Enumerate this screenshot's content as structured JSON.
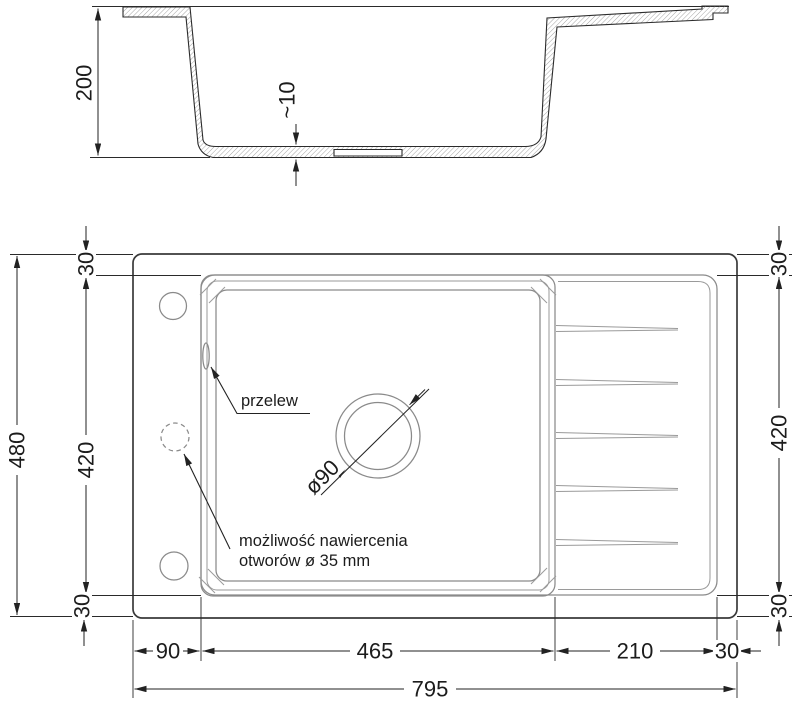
{
  "cross_section": {
    "depth": "200",
    "bottom_thickness": "~10"
  },
  "plan": {
    "left": {
      "total": "480",
      "inner": "420",
      "top": "30",
      "bottom": "30"
    },
    "right": {
      "top": "30",
      "inner": "420",
      "bottom": "30"
    },
    "bottom": {
      "left": "90",
      "bowl": "465",
      "drainer": "210",
      "right": "30",
      "total": "795"
    },
    "drain_diameter": "ø90",
    "overflow_label": "przelew",
    "drill_note_line1": "możliwość nawiercenia",
    "drill_note_line2": "otworów ø 35 mm"
  },
  "colors": {
    "line": "#222222",
    "thin": "#8a8a8a",
    "background": "#ffffff"
  }
}
